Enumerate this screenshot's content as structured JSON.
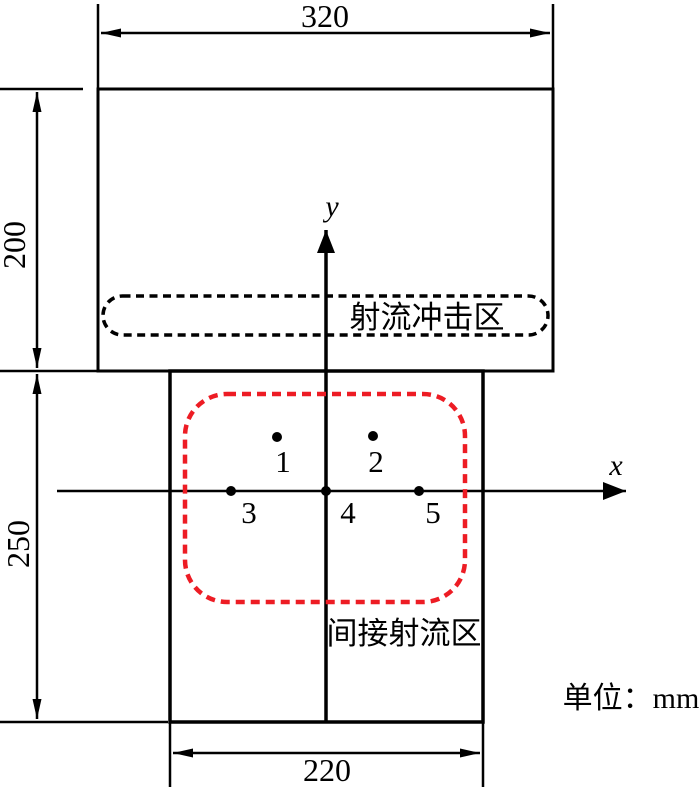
{
  "figure": {
    "title_hint": "jet-zone-dimension-diagram",
    "dims": {
      "top_width": "320",
      "upper_height": "200",
      "lower_height": "250",
      "bottom_width": "220"
    },
    "zones": {
      "jet_impact": "射流冲击区",
      "indirect_jet": "间接射流区"
    },
    "axes": {
      "x": "x",
      "y": "y"
    },
    "points": [
      {
        "label": "1"
      },
      {
        "label": "2"
      },
      {
        "label": "3"
      },
      {
        "label": "4"
      },
      {
        "label": "5"
      }
    ],
    "unit_note": "单位：mm",
    "colors": {
      "line": "#000000",
      "zone_highlight": "#ed1c24"
    }
  }
}
